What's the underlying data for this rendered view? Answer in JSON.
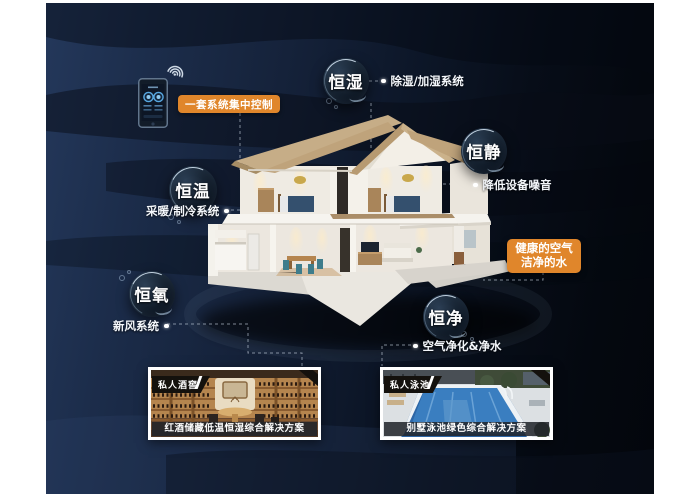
{
  "colors": {
    "accent_orange": "#e0862b",
    "background_left": "#24385b",
    "background_right": "#03060c",
    "connector": "#c8d2de",
    "bubble_rim": "#9db6cf"
  },
  "controller": {
    "label": "一套系统集中控制"
  },
  "icons": {
    "phone": "smart-home-controller",
    "wifi": "wifi-signal"
  },
  "bubbles": [
    {
      "label": "恒湿",
      "feature": "除湿/加湿系统"
    },
    {
      "label": "恒静",
      "feature": "降低设备噪音"
    },
    {
      "label": "恒温",
      "feature": "采暖/制冷系统"
    },
    {
      "label": "恒氧",
      "feature": "新风系统"
    },
    {
      "label": "恒净",
      "feature": "空气净化&净水"
    }
  ],
  "highlight_badge": {
    "line1": "健康的空气",
    "line2": "洁净的水"
  },
  "cards": [
    {
      "tag": "私人酒窖",
      "caption": "红酒储藏低温恒湿综合解决方案"
    },
    {
      "tag": "私人泳池",
      "caption": "别墅泳池绿色综合解决方案"
    }
  ]
}
